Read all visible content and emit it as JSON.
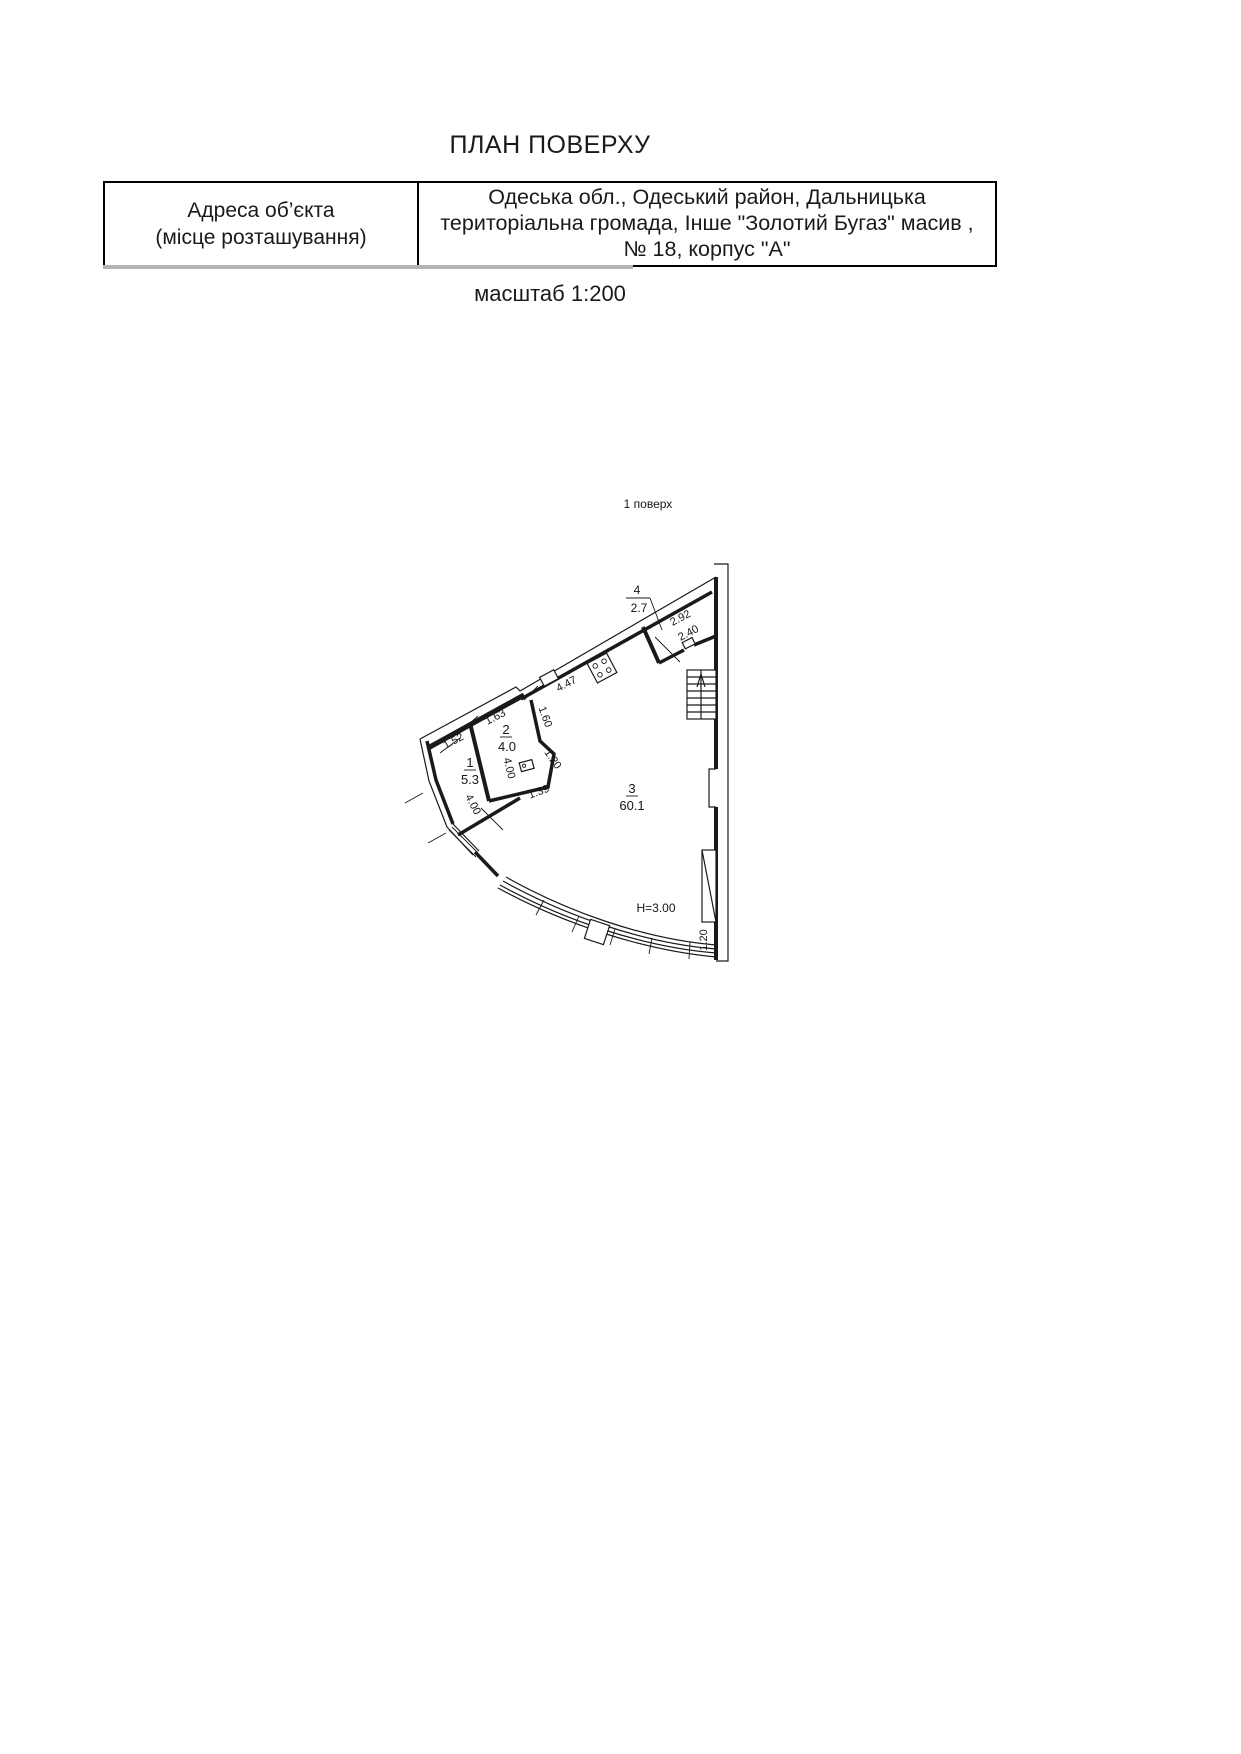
{
  "page": {
    "title": "ПЛАН ПОВЕРХУ",
    "scale": "масштаб 1:200",
    "floor": "1 поверх",
    "ink_color": "#1a1a1a"
  },
  "address_table": {
    "label": {
      "line1": "Адреса об’єкта",
      "line2": "(місце розташування)"
    },
    "value": "Одеська обл., Одеський район, Дальницька територіальна громада, Інше \"Золотий Бугаз\" масив , № 18, корпус \"А\""
  },
  "plan": {
    "rooms": {
      "r1": {
        "num": "1",
        "area": "5.3"
      },
      "r2": {
        "num": "2",
        "area": "4.0"
      },
      "r3": {
        "num": "3",
        "area": "60.1"
      },
      "r4": {
        "num": "4",
        "area": "2.7"
      }
    },
    "height": "H=3.00",
    "dims": {
      "top_152": "1.52",
      "top_163": "1.63",
      "top_447": "4.47",
      "r4_292": "2.92",
      "r4_240": "2.40",
      "r2_160": "1.60",
      "r2_120": "1.20",
      "r2_400": "4.00",
      "left_400": "4.00",
      "r2_139": "1.39",
      "win_120": "1.20"
    },
    "icons": [
      "gas-stove",
      "sink",
      "stairs",
      "window",
      "curved-glazing",
      "pier"
    ]
  }
}
